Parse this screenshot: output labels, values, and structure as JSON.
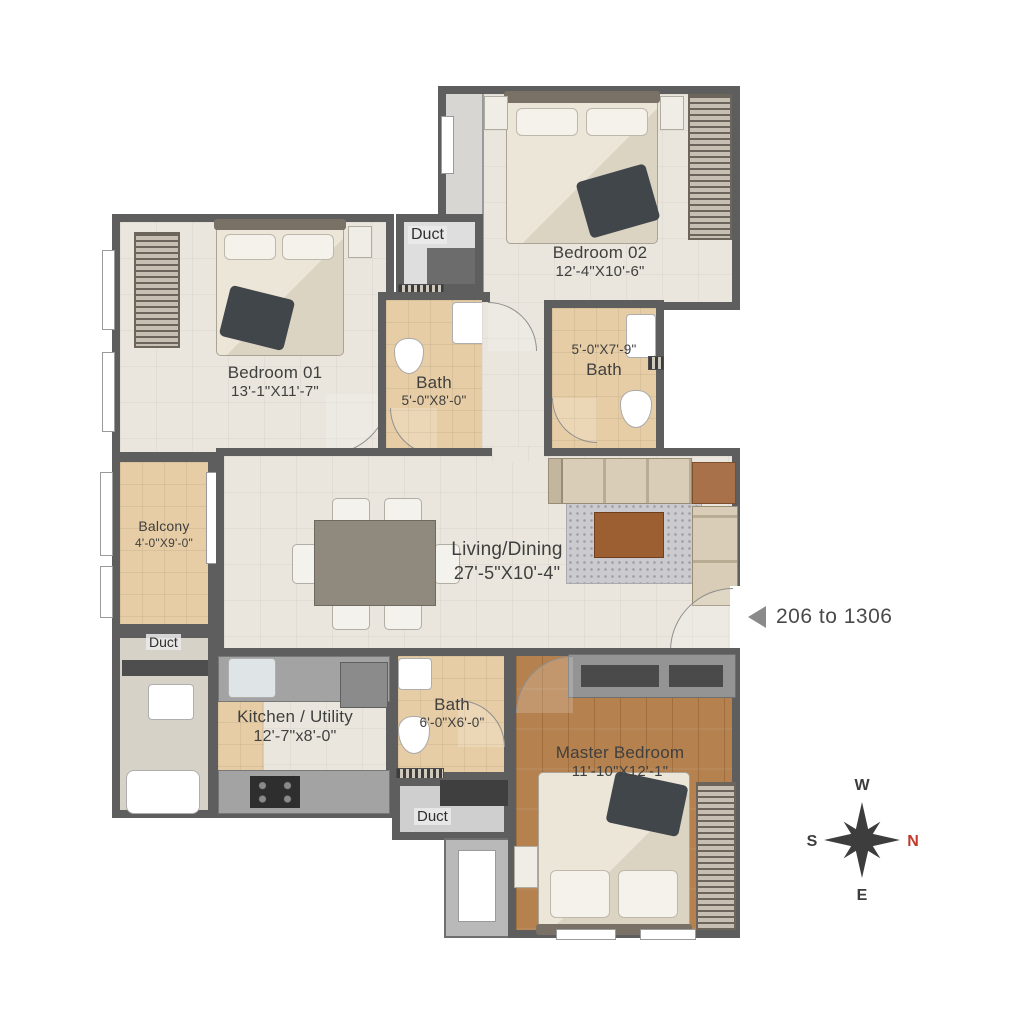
{
  "rooms": {
    "bedroom01": {
      "name": "Bedroom 01",
      "dims": "13'-1\"X11'-7\""
    },
    "bedroom02": {
      "name": "Bedroom 02",
      "dims": "12'-4\"X10'-6\""
    },
    "bath1": {
      "name": "Bath",
      "dims": "5'-0\"X8'-0\""
    },
    "bath2": {
      "name": "Bath",
      "dims": "5'-0\"X7'-9\""
    },
    "bath3": {
      "name": "Bath",
      "dims": "6'-0\"X6'-0\""
    },
    "balcony": {
      "name": "Balcony",
      "dims": "4'-0\"X9'-0\""
    },
    "living": {
      "name": "Living/Dining",
      "dims": "27'-5\"X10'-4\""
    },
    "kitchen": {
      "name": "Kitchen / Utility",
      "dims": "12'-7\"x8'-0\""
    },
    "master": {
      "name": "Master Bedroom",
      "dims": "11'-10\"X12'-1\""
    }
  },
  "ducts": {
    "top": "Duct",
    "left": "Duct",
    "bottom": "Duct"
  },
  "annotations": {
    "unit_range": "206 to 1306"
  },
  "compass": {
    "north": "N",
    "south": "S",
    "east": "E",
    "west": "W",
    "north_color": "#c0392b"
  },
  "colors": {
    "wall": "#5e5e5e",
    "floor_cream": "#eae6dd",
    "floor_bath": "#e7cda5",
    "floor_wood": "#b5814e",
    "duct_gray": "#dedede"
  }
}
